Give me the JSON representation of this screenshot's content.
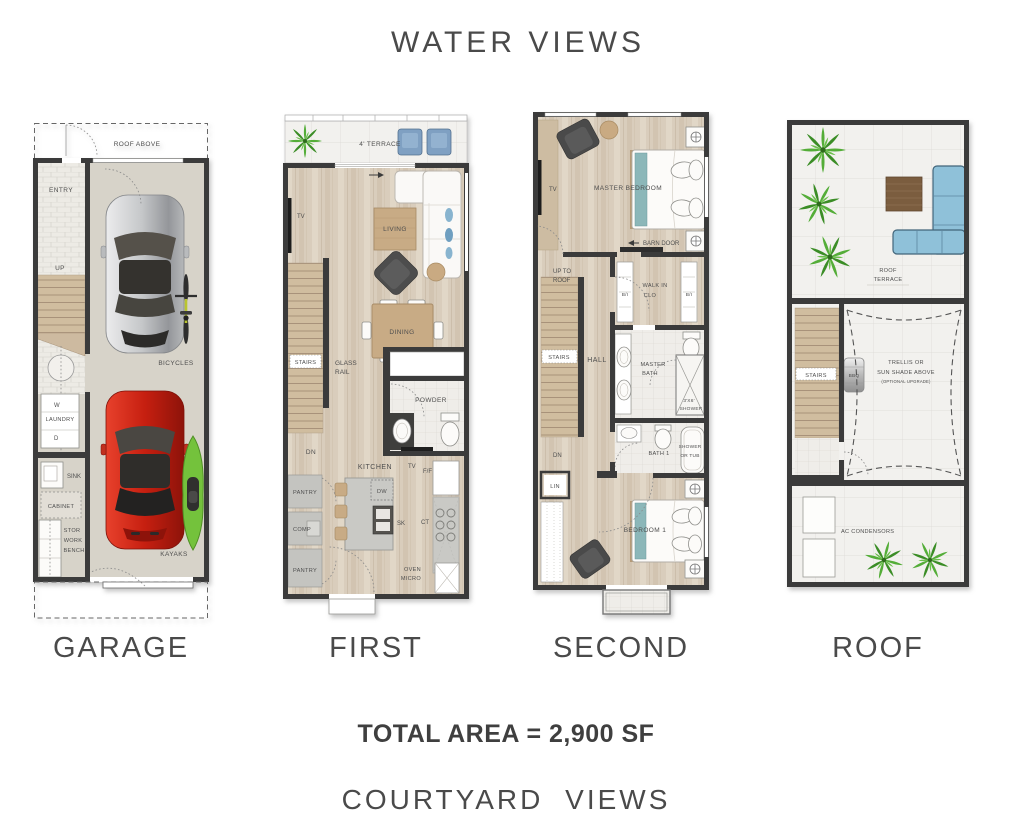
{
  "header": {
    "title": "WATER VIEWS"
  },
  "footer": {
    "total_area": "TOTAL AREA = 2,900 SF",
    "subtitle": "COURTYARD VIEWS"
  },
  "colors": {
    "wall": "#3b3b3b",
    "wood_floor": "#d9cdbc",
    "tile": "#f2f1ee",
    "stair_wood": "#d0bd9f",
    "accent_teal": "#8cb7b9",
    "sofa_blue": "#8fc1d9",
    "chair_blue": "#7fa0c2",
    "car_red": "#c61f10",
    "car_silver": "#c6c8ca",
    "kayak_green": "#74c23c",
    "palm_green": "#54ad38",
    "label": "#4a4a4a"
  },
  "plans": {
    "garage": {
      "title": "GARAGE",
      "labels": {
        "roof_above": "ROOF ABOVE",
        "entry": "ENTRY",
        "up": "UP",
        "w": "W",
        "laundry": "LAUNDRY",
        "d": "D",
        "sink": "SINK",
        "cabinet": "CABINET",
        "stor": "STOR",
        "work": "WORK",
        "bench": "BENCH",
        "bicycles": "BICYCLES",
        "kayaks": "KAYAKS"
      }
    },
    "first": {
      "title": "FIRST",
      "labels": {
        "terrace": "4' TERRACE",
        "tv": "TV",
        "living": "LIVING",
        "dining": "DINING",
        "stairs": "STAIRS",
        "glass": "GLASS",
        "rail": "RAIL",
        "dn": "DN",
        "powder": "POWDER",
        "kitchen": "KITCHEN",
        "tv2": "TV",
        "ff": "F/F",
        "dw": "DW",
        "sk": "SK",
        "ct": "CT",
        "oven": "OVEN",
        "micro": "MICRO",
        "pantry1": "PANTRY",
        "comp": "COMP",
        "pantry2": "PANTRY"
      }
    },
    "second": {
      "title": "SECOND",
      "labels": {
        "master_bedroom": "MASTER BEDROOM",
        "tv": "TV",
        "barn_door": "BARN DOOR",
        "up_to": "UP TO",
        "roof": "ROOF",
        "bi_left": "B/I",
        "walk_in": "WALK IN",
        "clo": "CLO",
        "bi_right": "B/I",
        "stairs": "STAIRS",
        "hall": "HALL",
        "master": "MASTER",
        "bath": "BATH",
        "shower_dim": "3'X6'",
        "shower": "SHOWER",
        "dn": "DN",
        "lin": "LIN",
        "bath1": "BATH 1",
        "shower_or": "SHOWER",
        "or_tub": "OR TUB",
        "bedroom1": "BEDROOM 1"
      }
    },
    "roof": {
      "title": "ROOF",
      "labels": {
        "roof": "ROOF",
        "terrace": "TERRACE",
        "stairs": "STAIRS",
        "bbq": "BBQ",
        "trellis1": "TRELLIS OR",
        "trellis2": "SUN SHADE ABOVE",
        "trellis3": "(OPTIONAL UPGRADE)",
        "ac": "AC CONDENSORS"
      }
    }
  }
}
